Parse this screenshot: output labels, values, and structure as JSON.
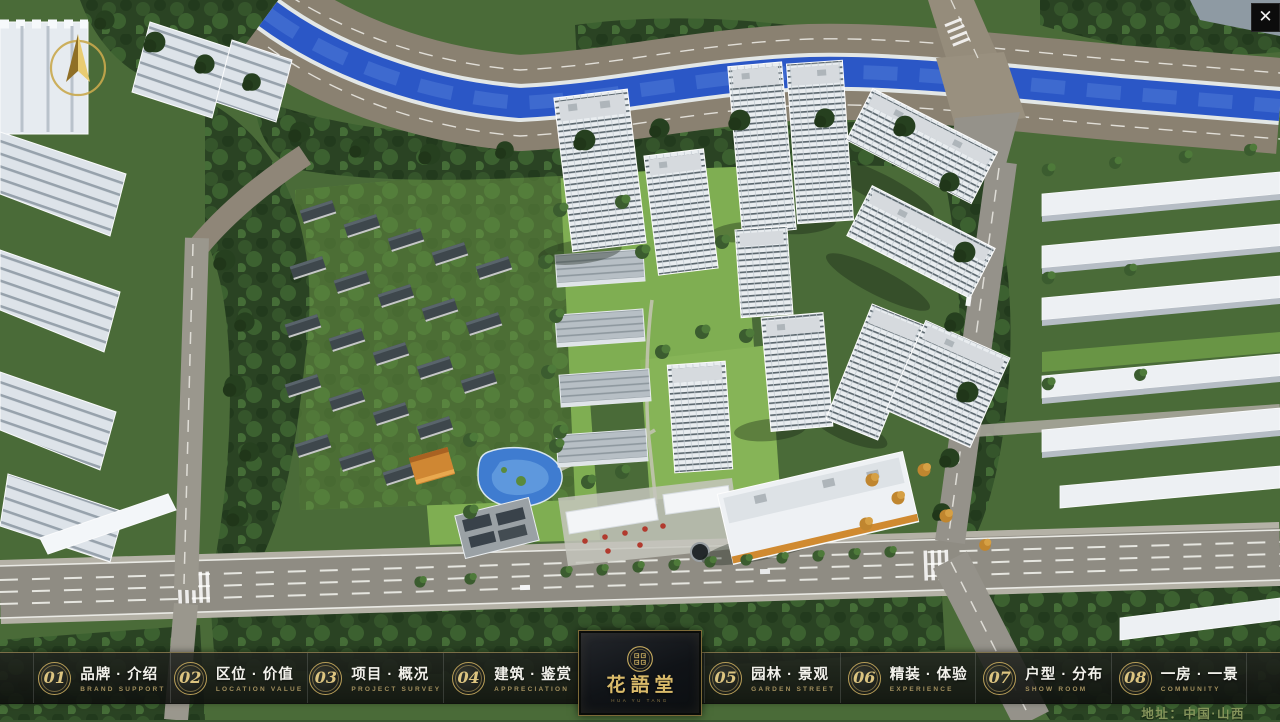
{
  "window": {
    "close_icon_glyph": "✕"
  },
  "navbar": {
    "items": [
      {
        "number": "01",
        "label": "品牌 · 介绍",
        "sublabel": "BRAND SUPPORT"
      },
      {
        "number": "02",
        "label": "区位 · 价值",
        "sublabel": "LOCATION VALUE"
      },
      {
        "number": "03",
        "label": "项目 · 概况",
        "sublabel": "PROJECT SURVEY"
      },
      {
        "number": "04",
        "label": "建筑 · 鉴赏",
        "sublabel": "APPRECIATION"
      },
      {
        "number": "05",
        "label": "园林 · 景观",
        "sublabel": "GARDEN STREET"
      },
      {
        "number": "06",
        "label": "精装 · 体验",
        "sublabel": "EXPERIENCE"
      },
      {
        "number": "07",
        "label": "户型 · 分布",
        "sublabel": "SHOW ROOM"
      },
      {
        "number": "08",
        "label": "一房 · 一景",
        "sublabel": "COMMUNITY"
      }
    ],
    "logo": {
      "title": "花語堂",
      "subtitle": "HUA YU TANG"
    }
  },
  "footer": {
    "address": "地址：中国·山西"
  },
  "icons": {
    "compass": "compass-north-arrow",
    "close": "close-x",
    "seal": "round-gold-seal"
  },
  "colors": {
    "accent_gold": "#c9ae66",
    "logo_gold": "#d9ba6a",
    "bar_background": "rgba(16,19,15,0.88)",
    "river_water": "#2b57c6",
    "lawn_green": "#7fae52",
    "forest_green": "#2a4323",
    "road_grey": "#8f8c83"
  }
}
